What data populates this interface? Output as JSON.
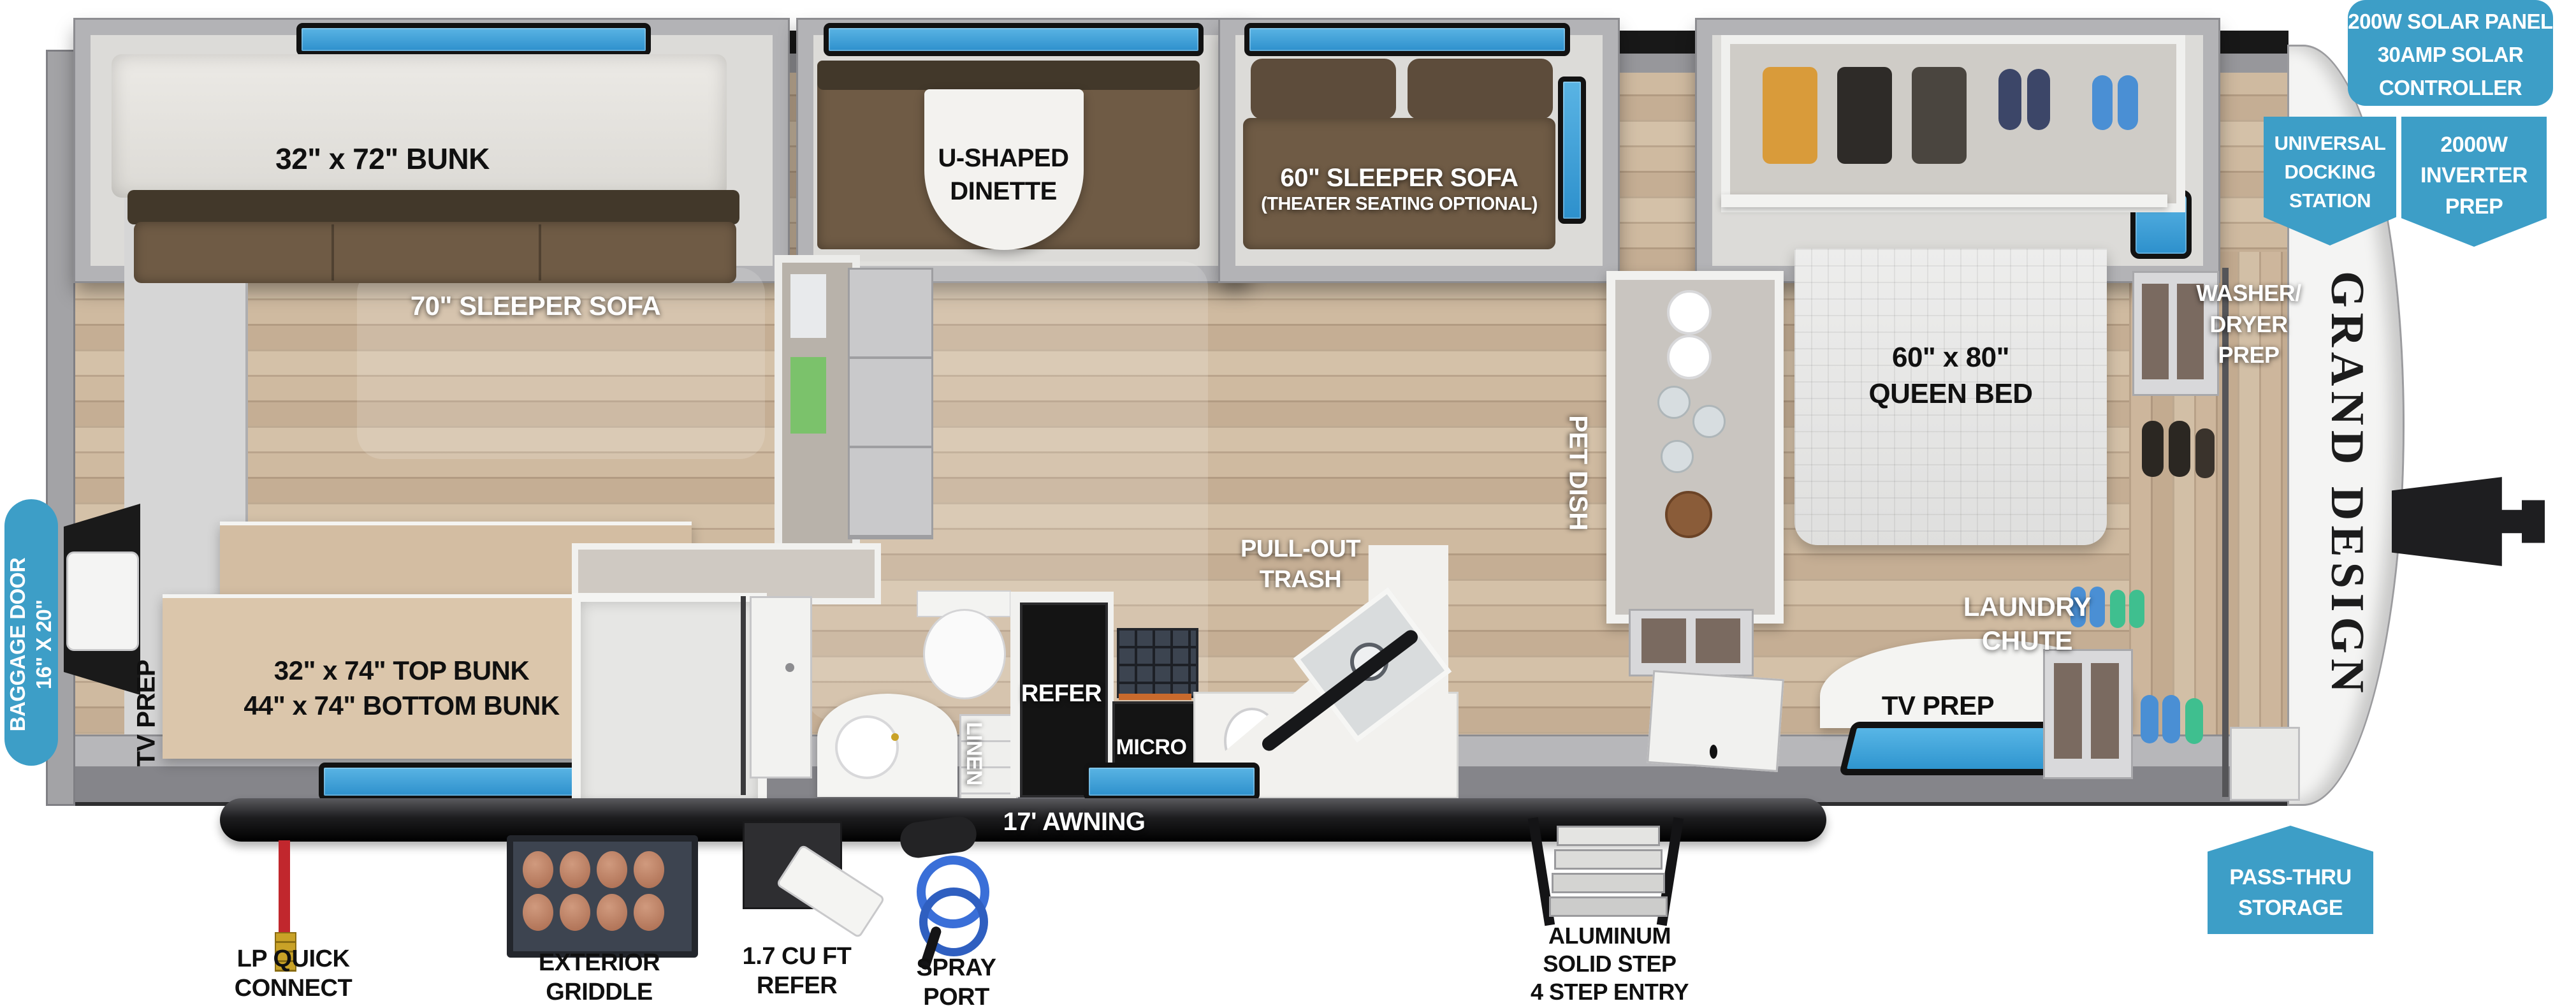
{
  "brand": {
    "logo_text": "GRAND DESIGN"
  },
  "colors": {
    "callout_blue": "#3D9EC7",
    "window_blue": "#2D90CC",
    "floor_tan": "#CDB89E",
    "sofa_brown": "#6F5B45",
    "wall_gray": "#B3B3B6",
    "appliance_black": "#141414",
    "awning_black": "#1D1D1F",
    "lp_red": "#C1272D",
    "spray_blue": "#3A6FD8",
    "patty_brown": "#B87A5E"
  },
  "callouts": {
    "solar": [
      "200W SOLAR PANEL",
      "30AMP SOLAR",
      "CONTROLLER"
    ],
    "docking": [
      "UNIVERSAL",
      "DOCKING",
      "STATION"
    ],
    "inverter": [
      "2000W",
      "INVERTER",
      "PREP"
    ],
    "pass_thru": [
      "PASS-THRU",
      "STORAGE"
    ],
    "baggage_door": [
      "BAGGAGE DOOR",
      "16\" X 20\""
    ]
  },
  "rooms": {
    "bunk_room": {
      "top_bunk": "32\" x 72\" BUNK",
      "sleeper_sofa": "70\" SLEEPER SOFA",
      "double_bunk": [
        "32\" x 74\" TOP BUNK",
        "44\" x 74\" BOTTOM BUNK"
      ],
      "tv_prep": "TV PREP"
    },
    "living": {
      "dinette": [
        "U-SHAPED",
        "DINETTE"
      ],
      "sleeper_sofa": [
        "60\" SLEEPER SOFA",
        "(THEATER SEATING OPTIONAL)"
      ]
    },
    "kitchen": {
      "pull_out_trash": [
        "PULL-OUT",
        "TRASH"
      ],
      "refer": "REFER",
      "micro": "MICRO",
      "linen": "LINEN",
      "pet_dish": "PET DISH"
    },
    "bedroom": {
      "queen_bed": [
        "60\" x 80\"",
        "QUEEN BED"
      ],
      "laundry_chute": [
        "LAUNDRY",
        "CHUTE"
      ],
      "tv_prep": "TV PREP",
      "washer_dryer": [
        "WASHER/",
        "DRYER",
        "PREP"
      ]
    }
  },
  "exterior": {
    "awning": "17' AWNING",
    "lp_quick_connect": [
      "LP QUICK",
      "CONNECT"
    ],
    "exterior_griddle": [
      "EXTERIOR",
      "GRIDDLE"
    ],
    "refer_1_7": [
      "1.7 CU FT",
      "REFER"
    ],
    "spray_port": [
      "SPRAY",
      "PORT"
    ],
    "entry_steps": [
      "ALUMINUM",
      "SOLID STEP",
      "4 STEP ENTRY"
    ]
  }
}
